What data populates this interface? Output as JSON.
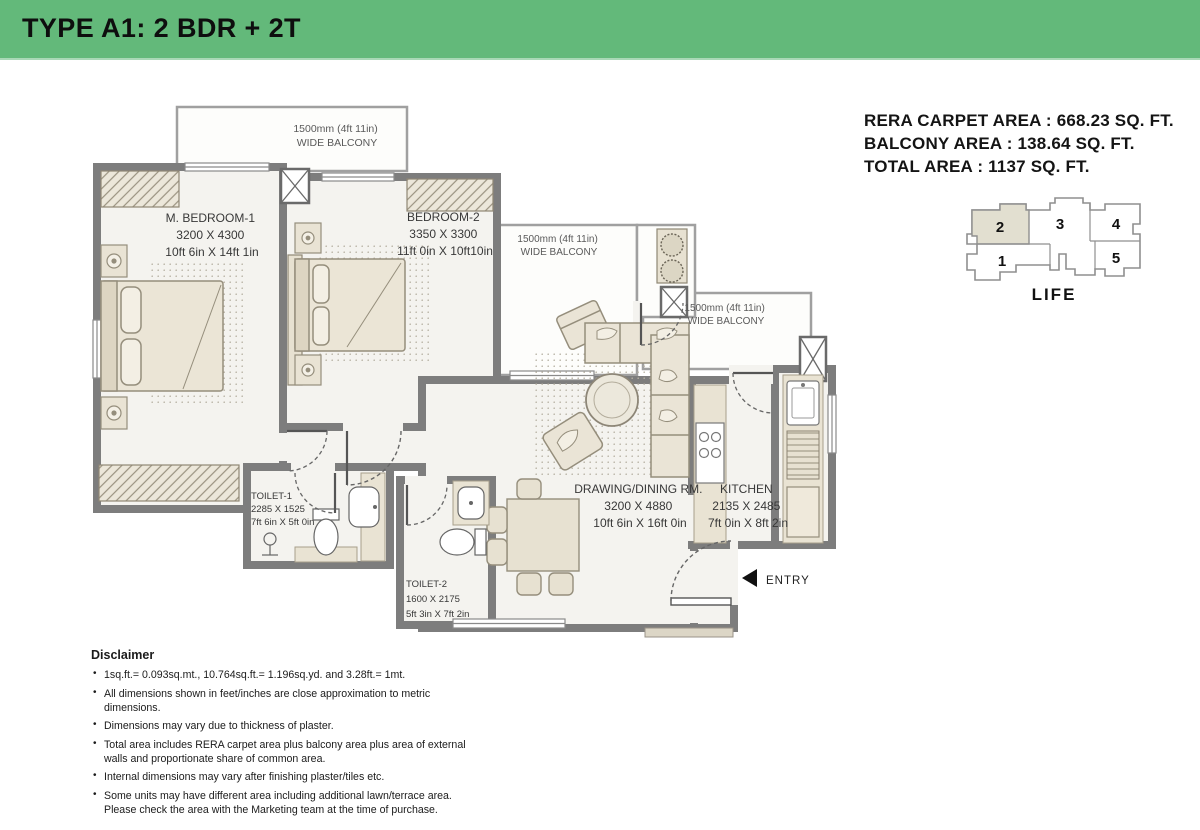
{
  "title_bar": {
    "title": "TYPE A1: 2 BDR + 2T"
  },
  "colors": {
    "header_green": "#63b97a",
    "wall_gray": "#7d7d7d",
    "furniture_beige": "#eae4d6",
    "keyplan_highlight": "#e2dfd0"
  },
  "area_summary": {
    "lines": [
      "RERA CARPET AREA : 668.23 SQ. FT.",
      "BALCONY AREA : 138.64 SQ. FT.",
      "TOTAL AREA :  1137 SQ. FT."
    ]
  },
  "rooms": {
    "master_bedroom": {
      "name": "M. BEDROOM-1",
      "mm": "3200 X 4300",
      "ft": "10ft 6in X 14ft 1in"
    },
    "bedroom2": {
      "name": "BEDROOM-2",
      "mm": "3350 X 3300",
      "ft": "11ft 0in X 10ft10in"
    },
    "drawing_dining": {
      "name": "DRAWING/DINING RM.",
      "mm": "3200 X 4880",
      "ft": "10ft 6in X 16ft 0in"
    },
    "kitchen": {
      "name": "KITCHEN",
      "mm": "2135 X 2485",
      "ft": "7ft 0in X 8ft 2in"
    },
    "toilet1": {
      "name": "TOILET-1",
      "mm": "2285 X 1525",
      "ft": "7ft 6in X 5ft 0in"
    },
    "toilet2": {
      "name": "TOILET-2",
      "mm": "1600 X 2175",
      "ft": "5ft 3in X 7ft 2in"
    }
  },
  "labels": {
    "balcony_mm": "1500mm (4ft 11in)",
    "balcony_wide": "WIDE BALCONY",
    "entry": "ENTRY"
  },
  "keyplan": {
    "units": [
      "1",
      "2",
      "3",
      "4",
      "5"
    ],
    "highlighted_unit": "2",
    "caption": "LIFE"
  },
  "disclaimer": {
    "heading": "Disclaimer",
    "bullets": [
      "1sq.ft.= 0.093sq.mt., 10.764sq.ft.= 1.196sq.yd. and 3.28ft.= 1mt.",
      "All dimensions shown in feet/inches are close approximation to metric dimensions.",
      "Dimensions may vary due to thickness of plaster.",
      "Total area includes RERA carpet area plus balcony area plus area of external walls and proportionate share of common area.",
      "Internal dimensions may vary after finishing plaster/tiles etc.",
      "Some units may have different area including additional lawn/terrace area. Please check the area with the Marketing team at the time of purchase."
    ]
  }
}
